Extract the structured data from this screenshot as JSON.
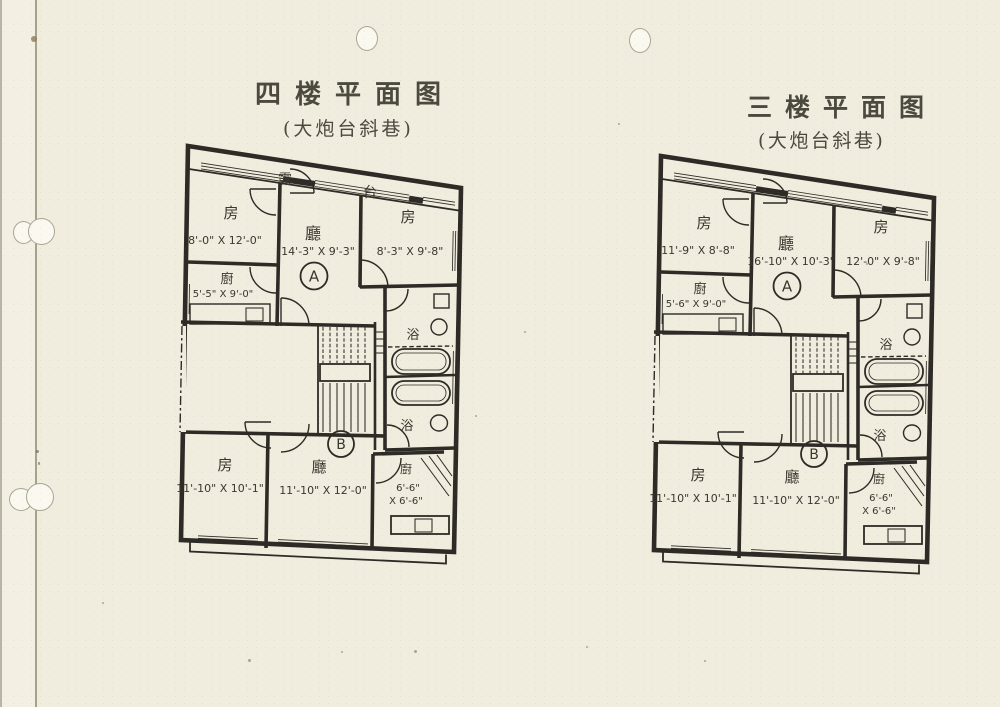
{
  "colors": {
    "paper": "#f0ecde",
    "ink": "#2e2b26",
    "pencil": "#4c4a3f",
    "hole": "#a8a694"
  },
  "plans": [
    {
      "title": "四楼平面图",
      "subtitle": "(大炮台斜巷)",
      "balcony_a": "露",
      "balcony_b": "台",
      "unit_a": "A",
      "unit_b": "B",
      "room_tl_label": "房",
      "room_tl_dims": "8'-0\" X 12'-0\"",
      "hall_a_label": "廳",
      "hall_a_dims": "14'-3\" X 9'-3\"",
      "room_tr_label": "房",
      "room_tr_dims": "8'-3\" X 9'-8\"",
      "kitchen_label": "廚",
      "kitchen_dims": "5'-5\" X 9'-0\"",
      "bath_upper_label": "浴",
      "bath_lower_label": "浴",
      "room_bl_label": "房",
      "room_bl_dims": "11'-10\" X 10'-1\"",
      "hall_b_label": "廳",
      "hall_b_dims": "11'-10\" X 12'-0\"",
      "kitchen2_label": "廚",
      "kitchen2_dims_line1": "6'-6\"",
      "kitchen2_dims_line2": "X 6'-6\""
    },
    {
      "title": "三楼平面图",
      "subtitle": "(大炮台斜巷)",
      "unit_a": "A",
      "unit_b": "B",
      "room_tl_label": "房",
      "room_tl_dims": "11'-9\" X 8'-8\"",
      "hall_a_label": "廳",
      "hall_a_dims": "16'-10\" X 10'-3\"",
      "room_tr_label": "房",
      "room_tr_dims": "12'-0\" X 9'-8\"",
      "kitchen_label": "廚",
      "kitchen_dims": "5'-6\" X 9'-0\"",
      "bath_upper_label": "浴",
      "bath_lower_label": "浴",
      "room_bl_label": "房",
      "room_bl_dims": "11'-10\" X 10'-1\"",
      "hall_b_label": "廳",
      "hall_b_dims": "11'-10\" X 12'-0\"",
      "kitchen2_label": "廚",
      "kitchen2_dims_line1": "6'-6\"",
      "kitchen2_dims_line2": "X 6'-6\""
    }
  ]
}
